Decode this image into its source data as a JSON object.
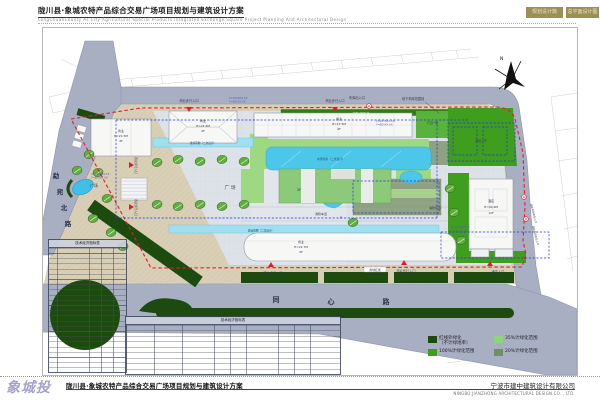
{
  "header": {
    "title": "陇川县·象城农特产品综合交易广场项目规划与建筑设计方案",
    "subtitle": "LongChuanCounty As City Agricultural Special Products Integrated Exchange Square Project Planning And Architectural Design",
    "badge1": "规划设计篇",
    "badge2": "总平面设计图"
  },
  "plan": {
    "north": "N",
    "road_west": [
      "勐",
      "宛",
      "北",
      "路"
    ],
    "road_south": [
      "同",
      "心",
      "路"
    ],
    "coord_x": "X=2076XX.XX",
    "coord_y": "Y=503XX.XX",
    "labels": {
      "plaza": "广场",
      "sunken": "下沉广场",
      "biz": "商业",
      "biz2f": "商业 2F",
      "h215": "H=21.5M",
      "h175": "H=17.5M",
      "h227": "H=22.7M",
      "f4": "4F",
      "d2f": "2F",
      "hotel": "酒店",
      "hotel_h": "H=49.9M",
      "hotel_f": "12F",
      "pool": "水景喷泉（二次设计）",
      "canopy": "玻璃雨棚（二次设计）",
      "fire1": "消防车道",
      "fire2": "消防环道",
      "garage_line": "地下车库范围线",
      "garage_entry": "车库出入口",
      "bike": "非机动停车位",
      "redline": "用地红线",
      "entry": "商业步行入口",
      "hotel_entry": "酒店入口",
      "hotel_car": "酒店机动车出入口",
      "p": "P"
    },
    "tables": {
      "t1": "技术经济指标表",
      "t2": "技术经济指标表"
    },
    "legend": {
      "i1a": "红线外绿化",
      "i1b": "（不计绿地率）",
      "i2": "35%计绿化范围",
      "i3": "100%计绿化范围",
      "i4": "20%计绿化范围",
      "c1": "#1d4a0e",
      "c2": "#8fd57a",
      "c3": "#3f9e1e",
      "c4": "#70905f"
    }
  },
  "footer": {
    "logo": "象城投资",
    "title": "陇川县·象城农特产品综合交易广场项目规划与建筑设计方案",
    "company": "宁波市建中建筑设计有限公司",
    "company_en": "NINGBO JIANZHONG ARCHITECTURAL DESIGN CO. , LTD."
  }
}
